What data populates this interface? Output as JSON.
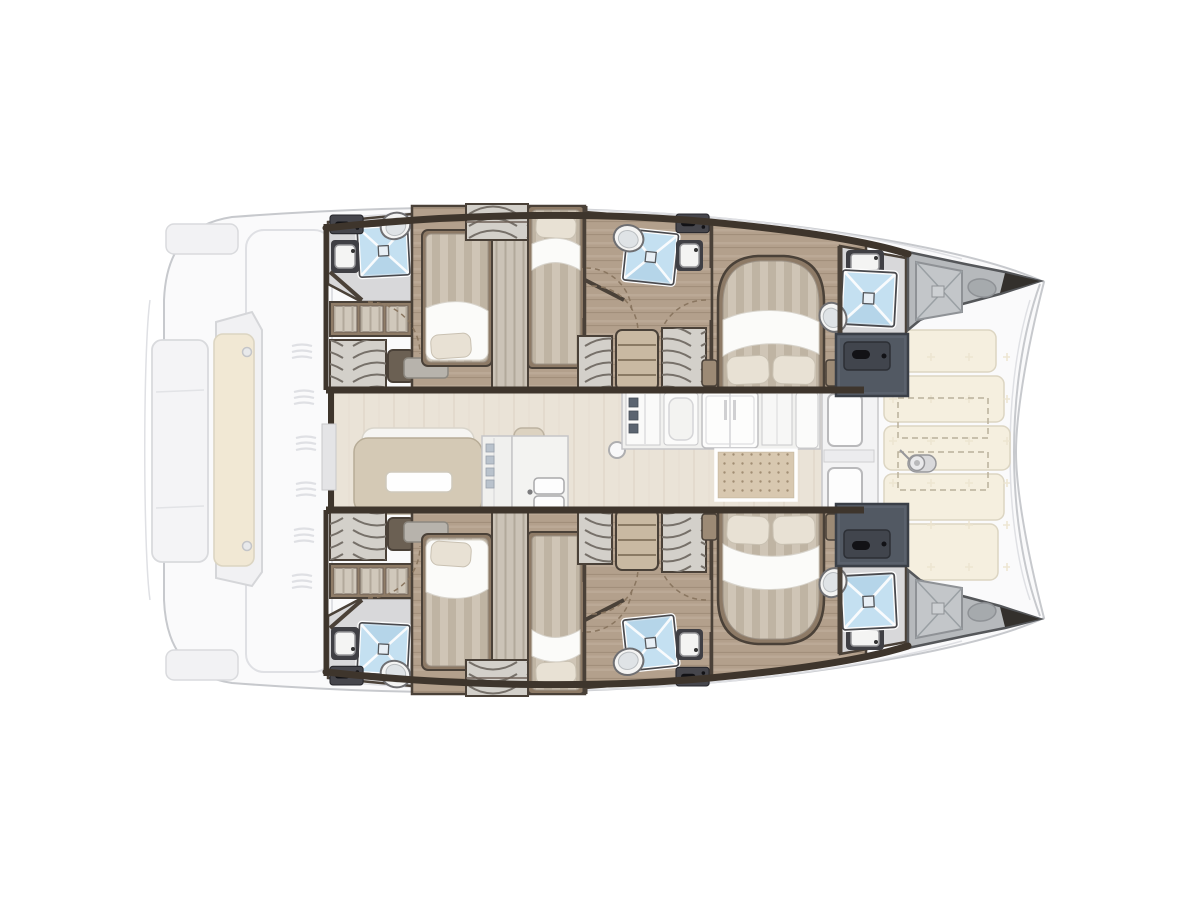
{
  "meta": {
    "description": "Top-down interior layout plan of a sailing catamaran, bow to the right, stern to the left. No text labels are rendered in the image.",
    "visible_text": []
  },
  "palette": {
    "page-bg": "#ffffff",
    "exterior-fill": "#fafafb",
    "exterior-line": "#c7c9cd",
    "detail-line": "#dfe0e4",
    "cockpit-cushion": "#f1e8d4",
    "foredeck-cushion": "#f5efdf",
    "cushion-line": "#dcd5c2",
    "wall": "#3e352c",
    "wall-line": "#4a4138",
    "wood": "#b3a08c",
    "wood-dark": "#a28f7b",
    "wood-light": "#c6b5a2",
    "saloon-floor": "#eae3d7",
    "saloon-grain": "#ddd4c4",
    "bed-base": "#cfc5b6",
    "bed-stripe": "#bfb4a3",
    "bed-frame": "#8d7a66",
    "sheet": "#fbfbf9",
    "pillow": "#e8e1d4",
    "head-floor": "#d8d8da",
    "shower-blue": "#c4e0f1",
    "fixture-white": "#f4f4f3",
    "slate": "#5a616c",
    "locker-dark": "#46464c",
    "handle-black": "#121216",
    "shelf-wood": "#8f7c67",
    "shelf-paper": "#d3d0ca",
    "drawer-wood": "#c9b9a2",
    "mat": "#d8c8b0",
    "door-arc": "#8a7660",
    "bow-gray": "#b6b9bc",
    "bow-hatch": "#c3c6c9",
    "bow-dark": "#33302c"
  },
  "vessel": {
    "type": "catamaran",
    "view": "overhead floor plan",
    "orientation": "bow right, stern left",
    "areas": {
      "stern_cockpit": {
        "features": [
          "transom platform",
          "side locker pods",
          "bench seat with cream cushion",
          "deck vent slits"
        ]
      },
      "saloon": {
        "features": [
          "lounge sofa with white headrest",
          "cocktail table",
          "tall cabinet",
          "double galley sink",
          "mast post",
          "galley counter modules",
          "refrigerator",
          "dotted floor mat",
          "sliding doors to foredeck"
        ]
      },
      "port_hull": {
        "features": [
          "aft head: shower, toilet, vanity sink, locker",
          "wardrobe shelves",
          "aft cabin double bed",
          "hanging locker partition",
          "aft cabin single bed",
          "mid head: shower, toilet, vanity sink, locker",
          "drawer unit and shelving",
          "forward island double bed",
          "forward head: vanity sink, shower, toilet",
          "forward wardrobe (slate)",
          "bow locker with cross-braced deck hatch"
        ]
      },
      "starboard_hull": {
        "features": [
          "mirror image of port hull"
        ]
      },
      "foredeck": {
        "features": [
          "five sun-cushion panels",
          "two dashed deck hatches",
          "anchor windlass"
        ]
      }
    }
  }
}
